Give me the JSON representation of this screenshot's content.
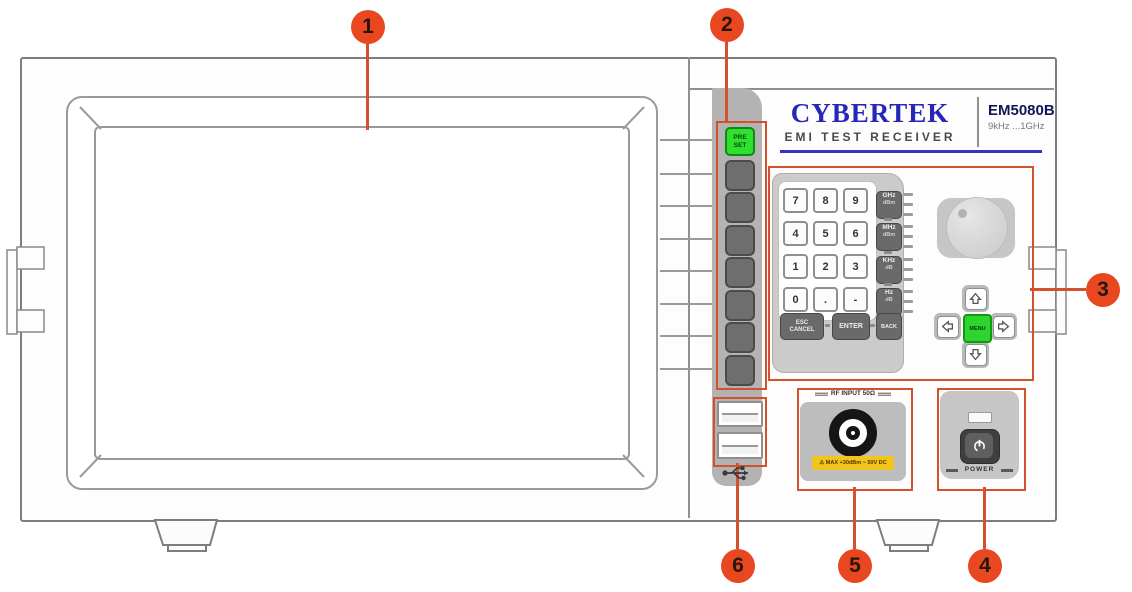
{
  "callouts": {
    "c1": "1",
    "c2": "2",
    "c3": "3",
    "c4": "4",
    "c5": "5",
    "c6": "6"
  },
  "brand": {
    "name": "CYBERTEK",
    "tagline": "EMI  TEST  RECEIVER",
    "model": "EM5080B",
    "freq_range": "9kHz ...1GHz"
  },
  "softkeys": {
    "preset": "PRE\nSET"
  },
  "keypad": {
    "digits": [
      "7",
      "8",
      "9",
      "4",
      "5",
      "6",
      "1",
      "2",
      "3",
      "0",
      ".",
      "-"
    ],
    "unit_keys": [
      {
        "unit": "GHz",
        "sub": "dBm"
      },
      {
        "unit": "MHz",
        "sub": "dBm"
      },
      {
        "unit": "KHz",
        "sub": "dB"
      },
      {
        "unit": "Hz",
        "sub": "dB"
      }
    ],
    "esc": "ESC\nCANCEL",
    "enter": "ENTER",
    "back": "BACK"
  },
  "nav": {
    "menu": "MENU"
  },
  "rf": {
    "header": "RF INPUT 50Ω",
    "warning": "⚠ MAX +30dBm ~ 50V DC"
  },
  "power": {
    "label": "POWER"
  },
  "colors": {
    "callout_circle": "#e8471f",
    "annotation_red": "#d4512e",
    "green_key": "#2fe02f",
    "brand_blue": "#2626b8",
    "warning_yellow": "#f2c41c"
  }
}
